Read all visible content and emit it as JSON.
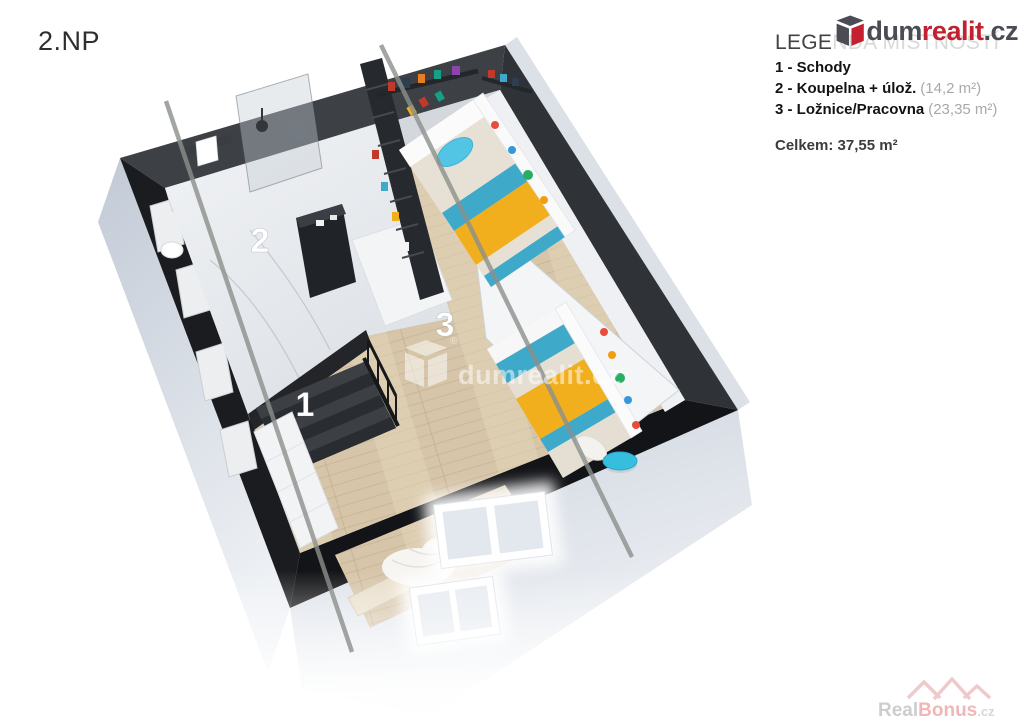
{
  "page": {
    "floor_label": "2.NP"
  },
  "legend": {
    "title": "LEGENDA MÍSTNOSTÍ",
    "items": [
      {
        "label": "1 - Schody",
        "area": ""
      },
      {
        "label": "2 - Koupelna + úlož.",
        "area": "(14,2 m²)"
      },
      {
        "label": "3 - Ložnice/Pracovna",
        "area": "(23,35 m²)"
      }
    ],
    "total": "Celkem: 37,55 m²"
  },
  "branding": {
    "dum": "dum",
    "realit": "realit",
    "cz": ".cz",
    "brand_red": "#c32030",
    "brand_gray": "#4b4b53"
  },
  "watermarks": {
    "center_text": "dumrealit.cz",
    "center_reg": "®",
    "corner_real": "Real",
    "corner_bonus": "Bonus",
    "corner_cz": ".cz"
  },
  "floorplan": {
    "room_labels": {
      "r1": "1",
      "r2": "2",
      "r3": "3"
    },
    "colors": {
      "wall_dark": "#141518",
      "wall_band_top": "#3d4145",
      "wood": "#d6c5a9",
      "marble": "#e9ebee",
      "accent_teal": "#3fa9ca",
      "accent_yellow": "#f1af1d",
      "pillow_blue": "#52c5e5",
      "pouf_blue": "#35bede",
      "exterior_wall": "#c6cdd9",
      "watermark_line": "#8c908c"
    }
  }
}
